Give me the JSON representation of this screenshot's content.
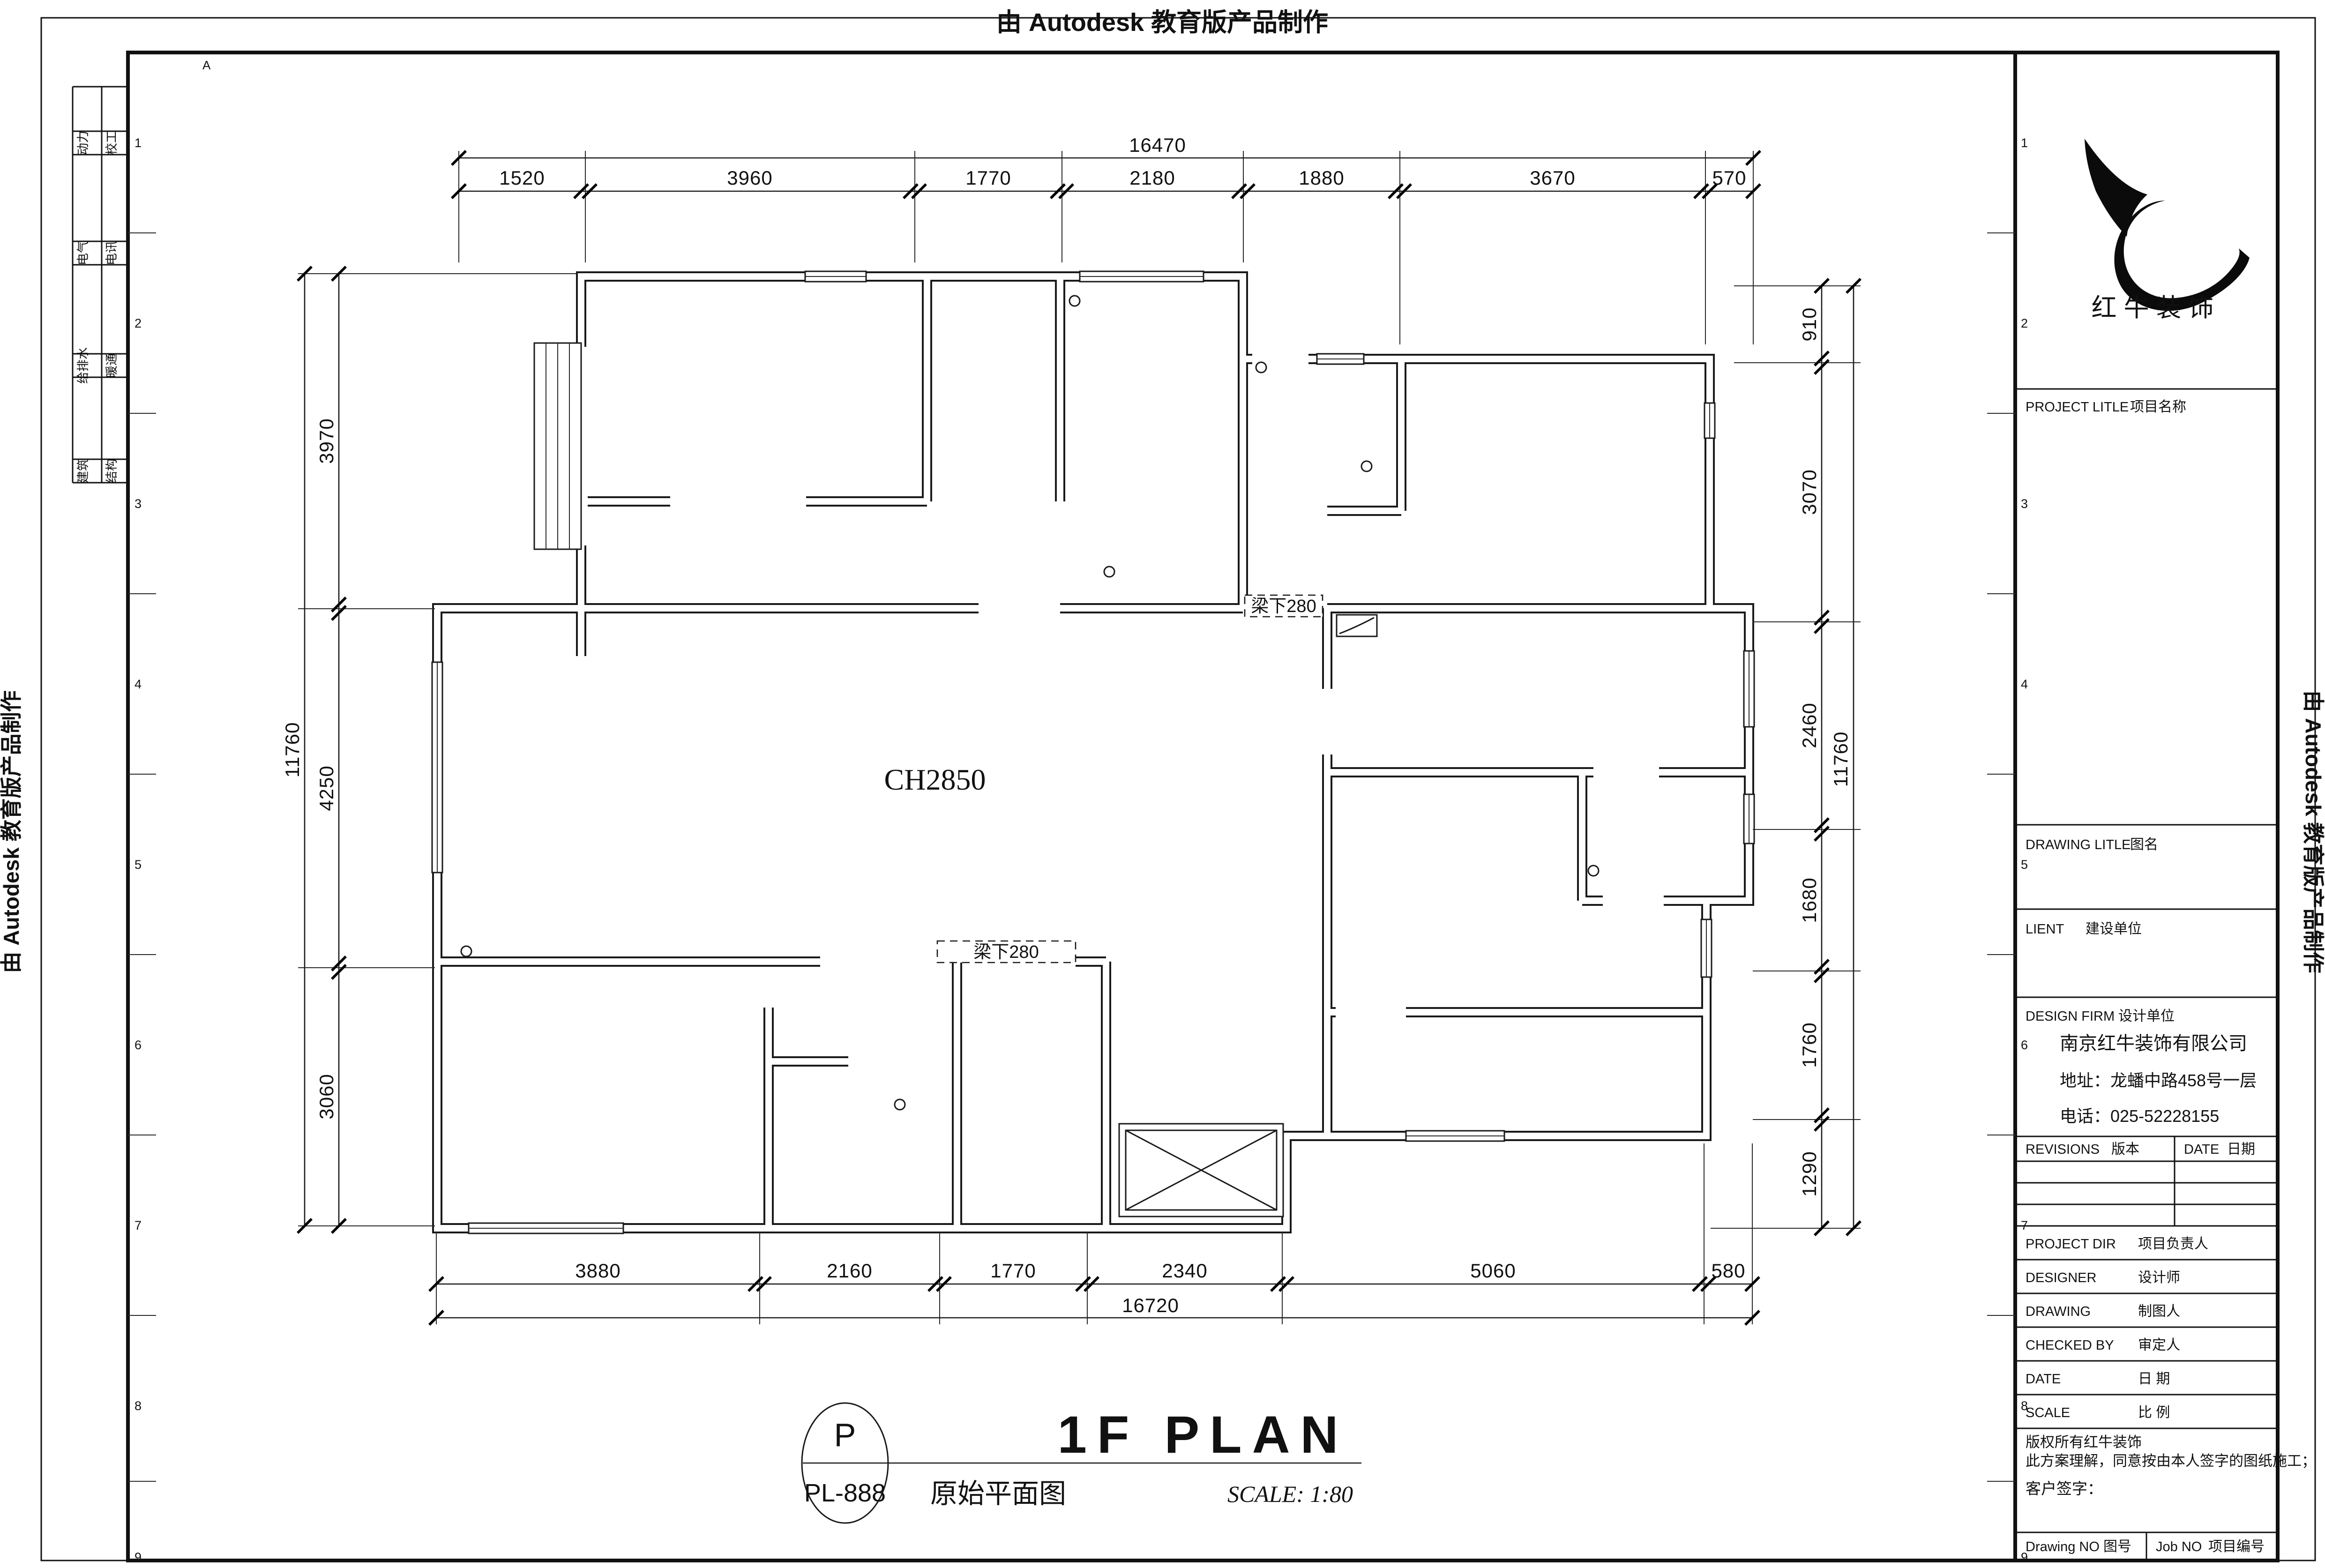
{
  "colors": {
    "ink": "#111111",
    "paper": "#ffffff"
  },
  "watermark": {
    "top": "由 Autodesk 教育版产品制作",
    "left": "由 Autodesk 教育版产品制作",
    "right": "由 Autodesk 教育版产品制作"
  },
  "sheet": {
    "marker_a": "A",
    "grid_numbers": [
      "1",
      "2",
      "3",
      "4",
      "5",
      "6",
      "7",
      "8",
      "9"
    ],
    "discipline_table": {
      "rows": [
        {
          "left": "动力",
          "right": "校工"
        },
        {
          "left": "电气",
          "right": "电讯"
        },
        {
          "left": "给排水",
          "right": "暖通"
        },
        {
          "left": "建筑",
          "right": "结构"
        }
      ]
    }
  },
  "plan": {
    "ceiling_label": "CH2850",
    "beam_note_top": "梁下280",
    "beam_note_bottom": "梁下280"
  },
  "dims": {
    "top": {
      "overall": "16470",
      "segments": [
        "1520",
        "3960",
        "1770",
        "2180",
        "1880",
        "3670",
        "570"
      ]
    },
    "bottom": {
      "overall": "16720",
      "segments": [
        "3880",
        "2160",
        "1770",
        "2340",
        "5060",
        "580"
      ]
    },
    "left": {
      "overall": "11760",
      "segments": [
        "3970",
        "4250",
        "3060"
      ]
    },
    "right": {
      "overall": "11760",
      "segments": [
        "910",
        "3070",
        "2460",
        "1680",
        "1760",
        "1290"
      ]
    }
  },
  "title_block": {
    "brand": {
      "logo_icon": "red-bull-logo",
      "name": "红 牛 装 饰"
    },
    "project_title": {
      "en": "PROJECT LITLE",
      "zh": "项目名称"
    },
    "drawing_title": {
      "en": "DRAWING LITLE",
      "zh": "图名"
    },
    "client": {
      "en": "LIENT",
      "zh": "建设单位"
    },
    "design_firm": {
      "en": "DESIGN FIRM",
      "zh": "设计单位"
    },
    "company": {
      "name": "南京红牛装饰有限公司",
      "address": "地址：龙蟠中路458号一层",
      "phone": "电话：025-52228155"
    },
    "revisions": {
      "en": "REVISIONS",
      "zh": "版本"
    },
    "date_col": {
      "en": "DATE",
      "zh": "日期"
    },
    "rows": [
      {
        "en": "PROJECT DIR",
        "zh": "项目负责人"
      },
      {
        "en": "DESIGNER",
        "zh": "设计师"
      },
      {
        "en": "DRAWING",
        "zh": "制图人"
      },
      {
        "en": "CHECKED BY",
        "zh": "审定人"
      },
      {
        "en": "DATE",
        "zh": "日  期"
      },
      {
        "en": "SCALE",
        "zh": "比  例"
      }
    ],
    "copyright_line1": "版权所有红牛装饰",
    "copyright_line2": "此方案理解，同意按由本人签字的图纸施工；",
    "customer_sign": "客户签字：",
    "drawing_no": {
      "en": "Drawing NO",
      "zh": "图号"
    },
    "job_no": {
      "en": "Job NO",
      "zh": "项目编号"
    }
  },
  "title_bar": {
    "bubble_top": "P",
    "bubble_bottom": "PL-888",
    "title": "1F PLAN",
    "subtitle": "原始平面图",
    "scale": "SCALE: 1:80"
  }
}
